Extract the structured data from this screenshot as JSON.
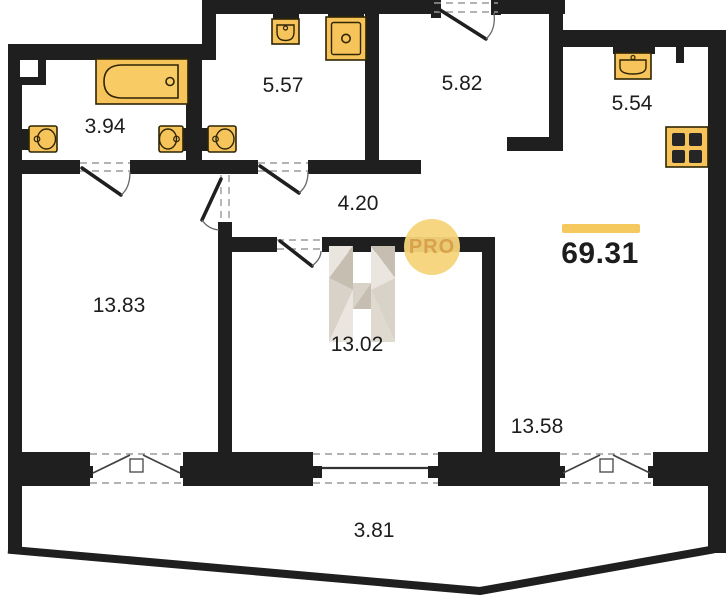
{
  "plan": {
    "title": "Apartment floor plan",
    "total_area": {
      "value": "69.31"
    },
    "watermark": {
      "pro": "PRO"
    },
    "rooms": [
      {
        "name": "bathroom",
        "area": "3.94"
      },
      {
        "name": "shower-room",
        "area": "5.57"
      },
      {
        "name": "hallway",
        "area": "5.82"
      },
      {
        "name": "kitchen",
        "area": "5.54"
      },
      {
        "name": "corridor",
        "area": "4.20"
      },
      {
        "name": "living-room",
        "area": "13.83"
      },
      {
        "name": "bedroom",
        "area": "13.02"
      },
      {
        "name": "room",
        "area": "13.58"
      },
      {
        "name": "balcony",
        "area": "3.81"
      }
    ],
    "colors": {
      "wall": "#1f1f1f",
      "fixture_fill": "#F6C45A",
      "fixture_stroke": "#2E2505",
      "accent_bar": "#F5C95D",
      "watermark_circle": "#F6D479",
      "watermark_text": "#D9A14A",
      "wardrobe_light": "#EAE5DE",
      "wardrobe_mid": "#D9D2C8",
      "wardrobe_dark": "#C7BEB2"
    }
  }
}
